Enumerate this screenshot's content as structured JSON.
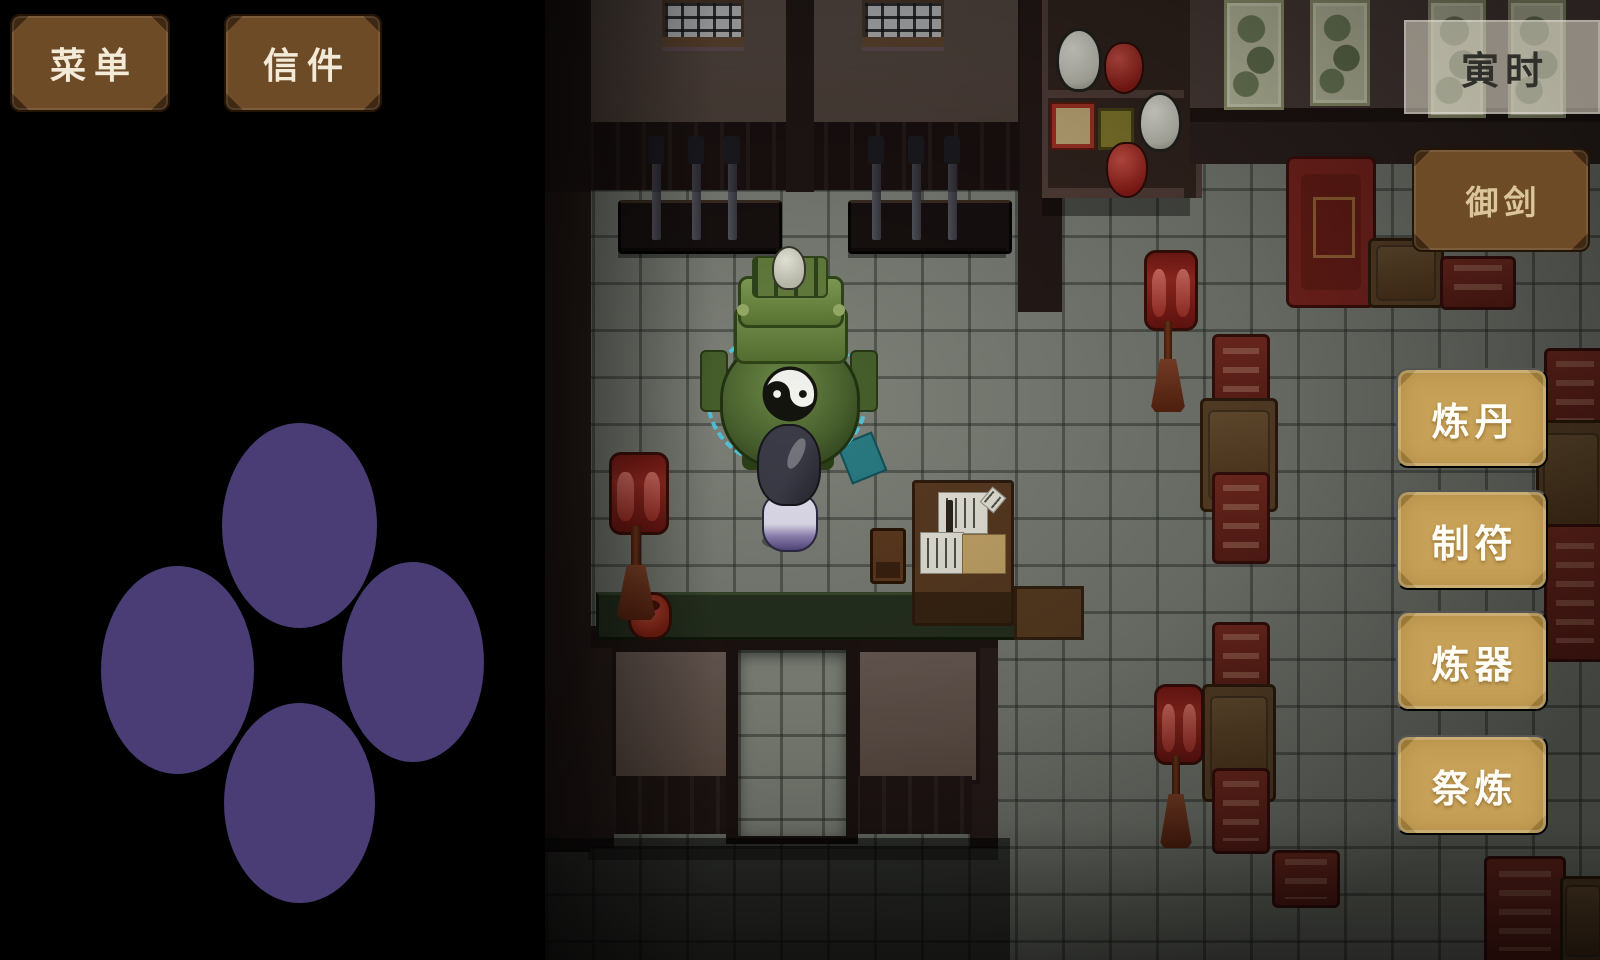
{
  "hud": {
    "menu_button": "菜单",
    "mail_button": "信件",
    "time_badge": "寅时",
    "sword_button": "御剑",
    "action_buttons": [
      {
        "label": "炼丹"
      },
      {
        "label": "制符"
      },
      {
        "label": "炼器"
      },
      {
        "label": "祭炼"
      }
    ]
  },
  "colors": {
    "hud_button_brown": "#6d4b26",
    "hud_button_tan": "#c7a157",
    "time_badge_bg": "rgba(228,222,206,0.55)",
    "dpad_purple": "#4a3c75",
    "glow_cyan": "#4fd2ea",
    "lantern_red": "#8e211c",
    "floor_gray": "#7d8178"
  }
}
